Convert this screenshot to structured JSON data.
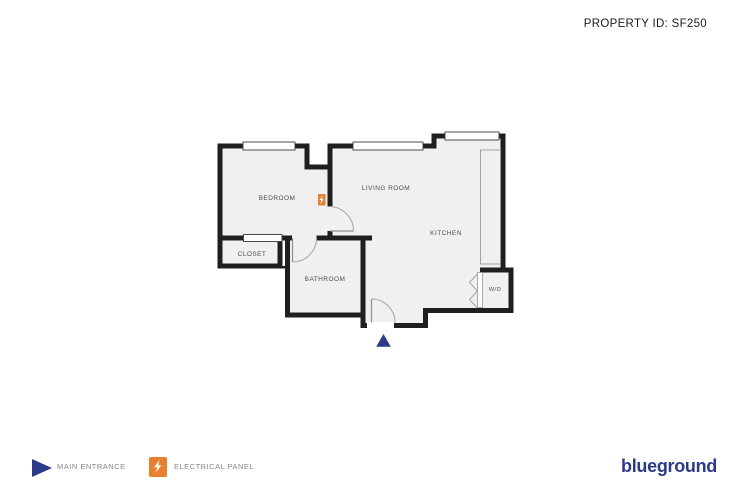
{
  "header": {
    "property_id": "PROPERTY ID: SF250"
  },
  "plan": {
    "room_labels": {
      "bedroom": "BEDROOM",
      "living_room": "LIVING ROOM",
      "kitchen": "KITCHEN",
      "closet": "CLOSET",
      "bathroom": "BATHROOM",
      "washer_dryer": "W/D"
    },
    "colors": {
      "wall": "#1f1f1f",
      "floor": "#f0f0f1",
      "accent_navy": "#2b3a8c",
      "accent_orange": "#e8802e",
      "label_gray": "#4e4e4e"
    }
  },
  "legend": {
    "main_entrance_label": "MAIN ENTRANCE",
    "electrical_panel_label": "ELECTRICAL PANEL"
  },
  "brand": {
    "logo_text": "blueground"
  }
}
